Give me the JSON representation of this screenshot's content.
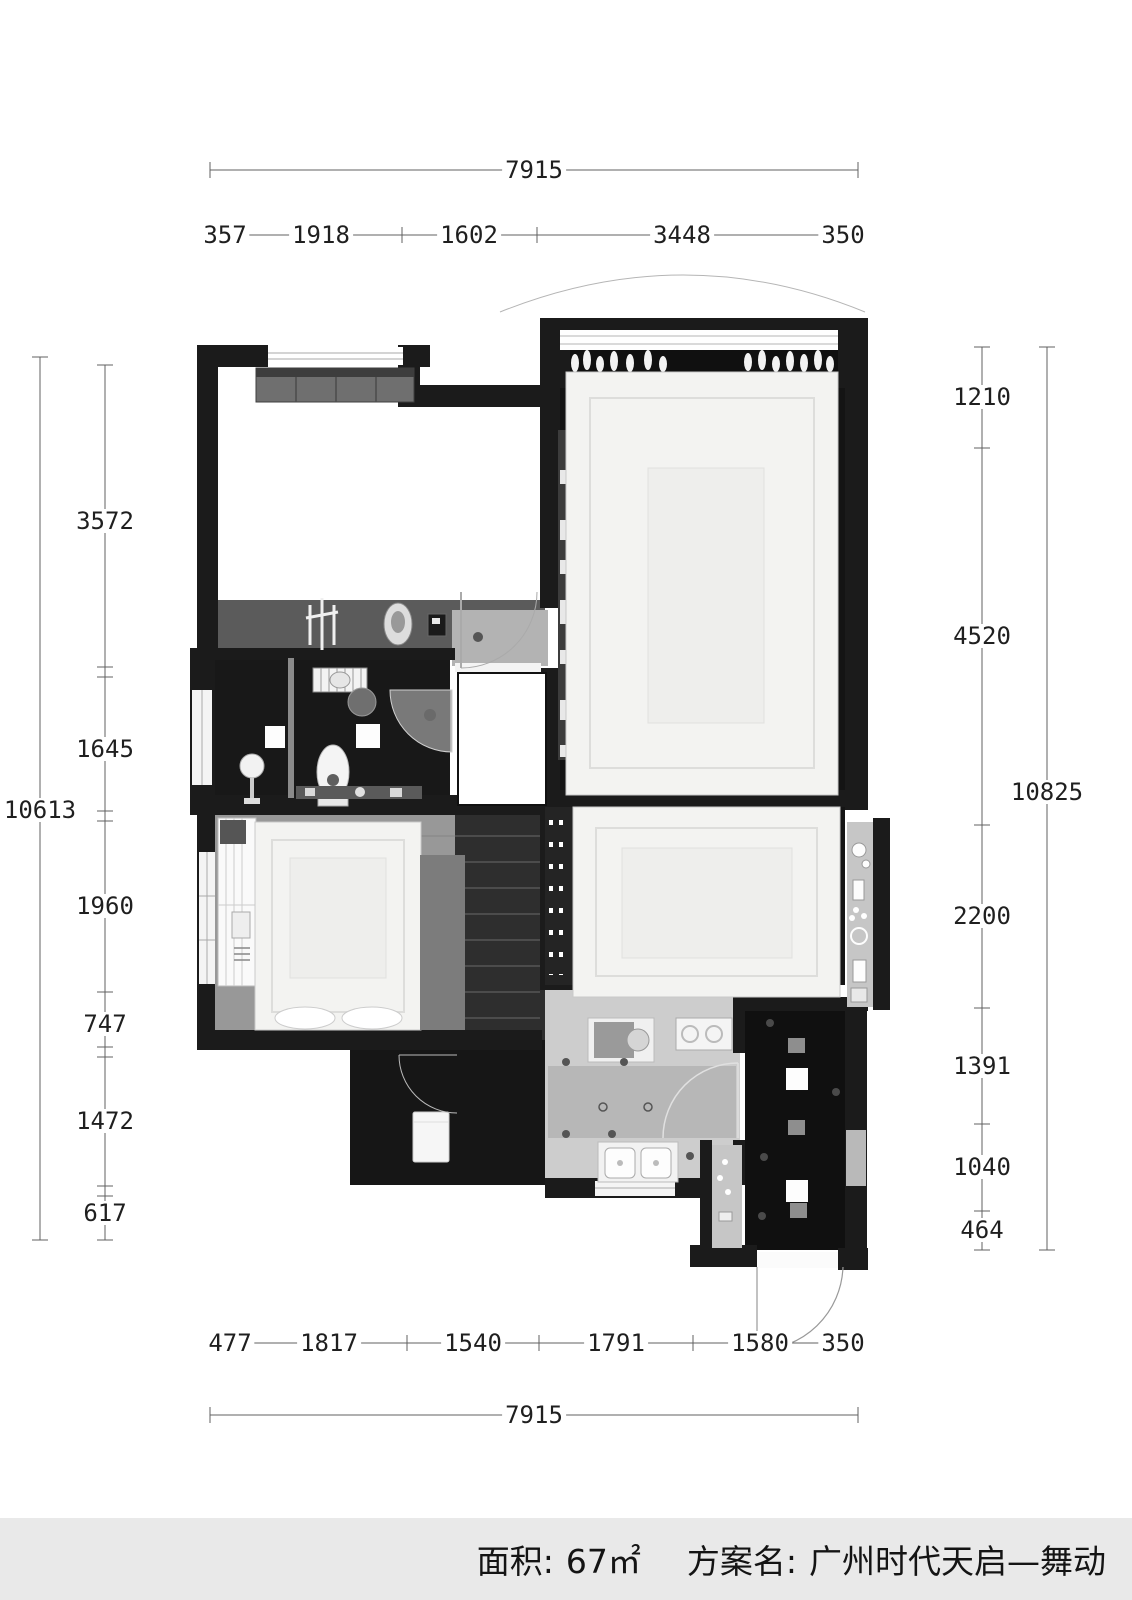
{
  "dimensions": {
    "top": {
      "total": "7915",
      "segments": [
        "357",
        "1918",
        "1602",
        "3448",
        "350"
      ]
    },
    "bottom": {
      "total": "7915",
      "segments": [
        "477",
        "1817",
        "1540",
        "1791",
        "1580",
        "350"
      ]
    },
    "left": {
      "total": "10613",
      "segments": [
        "3572",
        "1645",
        "1960",
        "747",
        "1472",
        "617"
      ]
    },
    "right": {
      "total": "10825",
      "segments": [
        "1210",
        "4520",
        "2200",
        "1391",
        "1040",
        "464"
      ]
    }
  },
  "footer": {
    "area_label": "面积:",
    "area_value": "67㎡",
    "plan_label": "方案名:",
    "plan_value": "广州时代天启—舞动"
  },
  "colors": {
    "wall": "#1b1b1b",
    "dark_floor": "#141414",
    "bathroom_floor": "#181818",
    "entry_floor": "#101010",
    "wood_floor": "#989898",
    "kitchen_floor": "#cdcdcd",
    "bed_white": "#f3f3f1",
    "dimension_line": "#606060",
    "dimension_text": "#1f1f1f",
    "footer_background": "#e9e9e9"
  }
}
